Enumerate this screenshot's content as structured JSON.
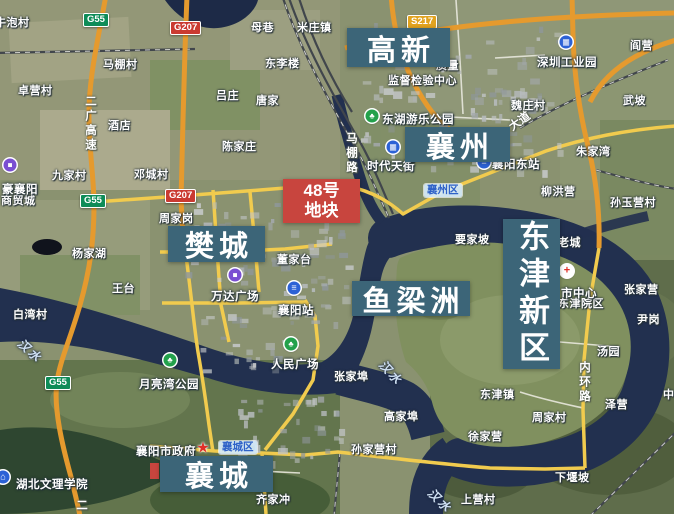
{
  "map": {
    "area_labels": [
      {
        "text": "高新",
        "x": 347,
        "y": 28,
        "w": 103,
        "h": 39,
        "vertical": false
      },
      {
        "text": "襄州",
        "x": 405,
        "y": 127,
        "w": 105,
        "h": 35,
        "vertical": false
      },
      {
        "text": "樊城",
        "x": 168,
        "y": 226,
        "w": 97,
        "h": 36,
        "vertical": false
      },
      {
        "text": "鱼梁洲",
        "x": 352,
        "y": 281,
        "w": 118,
        "h": 35,
        "vertical": false
      },
      {
        "text": "襄城",
        "x": 160,
        "y": 456,
        "w": 113,
        "h": 36,
        "vertical": false
      },
      {
        "text": "东津新区",
        "x": 503,
        "y": 219,
        "w": 57,
        "h": 150,
        "vertical": true
      }
    ],
    "plot_label": {
      "line1": "48号",
      "line2": "地块",
      "x": 283,
      "y": 179,
      "w": 77,
      "h": 44,
      "color": "#c8453e"
    },
    "district_badges": [
      {
        "text": "襄州区",
        "x": 424,
        "y": 184
      },
      {
        "text": "襄城区",
        "x": 219,
        "y": 441
      }
    ],
    "road_badges": [
      {
        "text": "G55",
        "x": 83,
        "y": 13,
        "color": "#0e8c58"
      },
      {
        "text": "G55",
        "x": 80,
        "y": 194,
        "color": "#0e8c58"
      },
      {
        "text": "G55",
        "x": 45,
        "y": 376,
        "color": "#0e8c58"
      },
      {
        "text": "G207",
        "x": 170,
        "y": 21,
        "color": "#ca3a31"
      },
      {
        "text": "G207",
        "x": 165,
        "y": 189,
        "color": "#ca3a31"
      },
      {
        "text": "S217",
        "x": 407,
        "y": 15,
        "color": "#e2a31f"
      }
    ],
    "pois": [
      {
        "text": "东湖游乐公园",
        "icon": "park",
        "ix": 372,
        "iy": 116,
        "tx": 382,
        "ty": 111
      },
      {
        "text": "月亮湾公园",
        "icon": "park",
        "ix": 170,
        "iy": 360,
        "tx": 139,
        "ty": 376
      },
      {
        "text": "人民广场",
        "icon": "park",
        "ix": 291,
        "iy": 344,
        "tx": 271,
        "ty": 356
      },
      {
        "text": "襄阳站",
        "icon": "train",
        "ix": 294,
        "iy": 288,
        "tx": 278,
        "ty": 302
      },
      {
        "text": "襄阳东站",
        "icon": "train",
        "ix": 484,
        "iy": 162,
        "tx": 492,
        "ty": 156
      },
      {
        "text": "深圳工业园",
        "icon": "industry",
        "ix": 566,
        "iy": 42,
        "tx": 537,
        "ty": 54
      },
      {
        "text": "时代天街",
        "icon": "industry",
        "ix": 393,
        "iy": 147,
        "tx": 367,
        "ty": 158
      },
      {
        "text": "万达广场",
        "icon": "mall",
        "ix": 235,
        "iy": 275,
        "tx": 211,
        "ty": 288
      },
      {
        "text": "豪襄阳",
        "icon": "mall",
        "ix": 10,
        "iy": 165,
        "tx": 2,
        "ty": 181
      },
      {
        "text": "襄阳市政府",
        "icon": "gov",
        "ix": 203,
        "iy": 448,
        "tx": 136,
        "ty": 443
      },
      {
        "text": "湖北文理学院",
        "icon": "school",
        "ix": 3,
        "iy": 477,
        "tx": 16,
        "ty": 476
      },
      {
        "text": "市中心",
        "icon": "hospital",
        "ix": 567,
        "iy": 271,
        "tx": 561,
        "ty": 285
      }
    ],
    "villages": [
      {
        "text": "牛泡村",
        "x": -5,
        "y": 17
      },
      {
        "text": "马棚村",
        "x": 103,
        "y": 59
      },
      {
        "text": "卓营村",
        "x": 18,
        "y": 85
      },
      {
        "text": "酒店",
        "x": 108,
        "y": 120
      },
      {
        "text": "母巷",
        "x": 251,
        "y": 22
      },
      {
        "text": "米庄镇",
        "x": 297,
        "y": 22
      },
      {
        "text": "东李楼",
        "x": 265,
        "y": 58
      },
      {
        "text": "吕庄",
        "x": 216,
        "y": 90
      },
      {
        "text": "唐家",
        "x": 256,
        "y": 95
      },
      {
        "text": "陈家庄",
        "x": 222,
        "y": 141
      },
      {
        "text": "阎营",
        "x": 630,
        "y": 40
      },
      {
        "text": "魏庄村",
        "x": 511,
        "y": 100
      },
      {
        "text": "武坡",
        "x": 623,
        "y": 95
      },
      {
        "text": "朱家湾",
        "x": 576,
        "y": 146
      },
      {
        "text": "九家村",
        "x": 52,
        "y": 170
      },
      {
        "text": "邓城村",
        "x": 134,
        "y": 169
      },
      {
        "text": "周家岗",
        "x": 159,
        "y": 213
      },
      {
        "text": "杨家湖",
        "x": 72,
        "y": 248
      },
      {
        "text": "王台",
        "x": 112,
        "y": 283
      },
      {
        "text": "白湾村",
        "x": 13,
        "y": 309
      },
      {
        "text": "董家台",
        "x": 277,
        "y": 254
      },
      {
        "text": "要家坡",
        "x": 455,
        "y": 234
      },
      {
        "text": "老城",
        "x": 558,
        "y": 237
      },
      {
        "text": "柳洪营",
        "x": 541,
        "y": 186
      },
      {
        "text": "孙玉营村",
        "x": 610,
        "y": 197
      },
      {
        "text": "张家营",
        "x": 624,
        "y": 284
      },
      {
        "text": "尹岗",
        "x": 637,
        "y": 314
      },
      {
        "text": "汤园",
        "x": 597,
        "y": 346
      },
      {
        "text": "东津镇",
        "x": 480,
        "y": 389
      },
      {
        "text": "周家村",
        "x": 532,
        "y": 412
      },
      {
        "text": "徐家营",
        "x": 468,
        "y": 431
      },
      {
        "text": "泽营",
        "x": 605,
        "y": 399
      },
      {
        "text": "下堰坡",
        "x": 555,
        "y": 472
      },
      {
        "text": "张家埠",
        "x": 334,
        "y": 371
      },
      {
        "text": "高家埠",
        "x": 384,
        "y": 411
      },
      {
        "text": "孙家营村",
        "x": 351,
        "y": 444
      },
      {
        "text": "上营村",
        "x": 461,
        "y": 494
      },
      {
        "text": "齐家冲",
        "x": 256,
        "y": 494
      },
      {
        "text": "东津院区",
        "x": 558,
        "y": 298
      },
      {
        "text": "商贸城",
        "x": 1,
        "y": 195
      },
      {
        "text": "监督检验中心",
        "x": 388,
        "y": 75
      },
      {
        "text": "质量",
        "x": 436,
        "y": 60
      },
      {
        "text": "中",
        "x": 663,
        "y": 389
      }
    ],
    "road_names": [
      {
        "text": "二广高速",
        "x": 82,
        "y": 95,
        "vertical": true,
        "rotate": 0
      },
      {
        "text": "二",
        "x": 73,
        "y": 499,
        "vertical": true,
        "rotate": 0
      },
      {
        "text": "内环路",
        "x": 576,
        "y": 361,
        "vertical": true,
        "rotate": 0
      },
      {
        "text": "马棚路",
        "x": 343,
        "y": 132,
        "vertical": true,
        "rotate": 0
      },
      {
        "text": "大道",
        "x": 508,
        "y": 113,
        "vertical": false,
        "rotate": -35
      }
    ],
    "river_labels": [
      {
        "text": "汉水",
        "x": 16,
        "y": 342,
        "rotate": 42
      },
      {
        "text": "汉水",
        "x": 377,
        "y": 364,
        "rotate": 48
      },
      {
        "text": "汉水",
        "x": 426,
        "y": 492,
        "rotate": 45
      }
    ],
    "icon_glyphs": {
      "park": "♣",
      "train": "≡",
      "mall": "■",
      "industry": "▦",
      "school": "⌂",
      "hospital": "+",
      "gov": "★"
    },
    "colors": {
      "annotation_box": "#3c6578",
      "plot_box": "#c8453e",
      "river": "#22304f",
      "highway": "#e59a2e",
      "arterial": "#f1cb4e",
      "district_badge_text": "#2f62c8"
    }
  }
}
